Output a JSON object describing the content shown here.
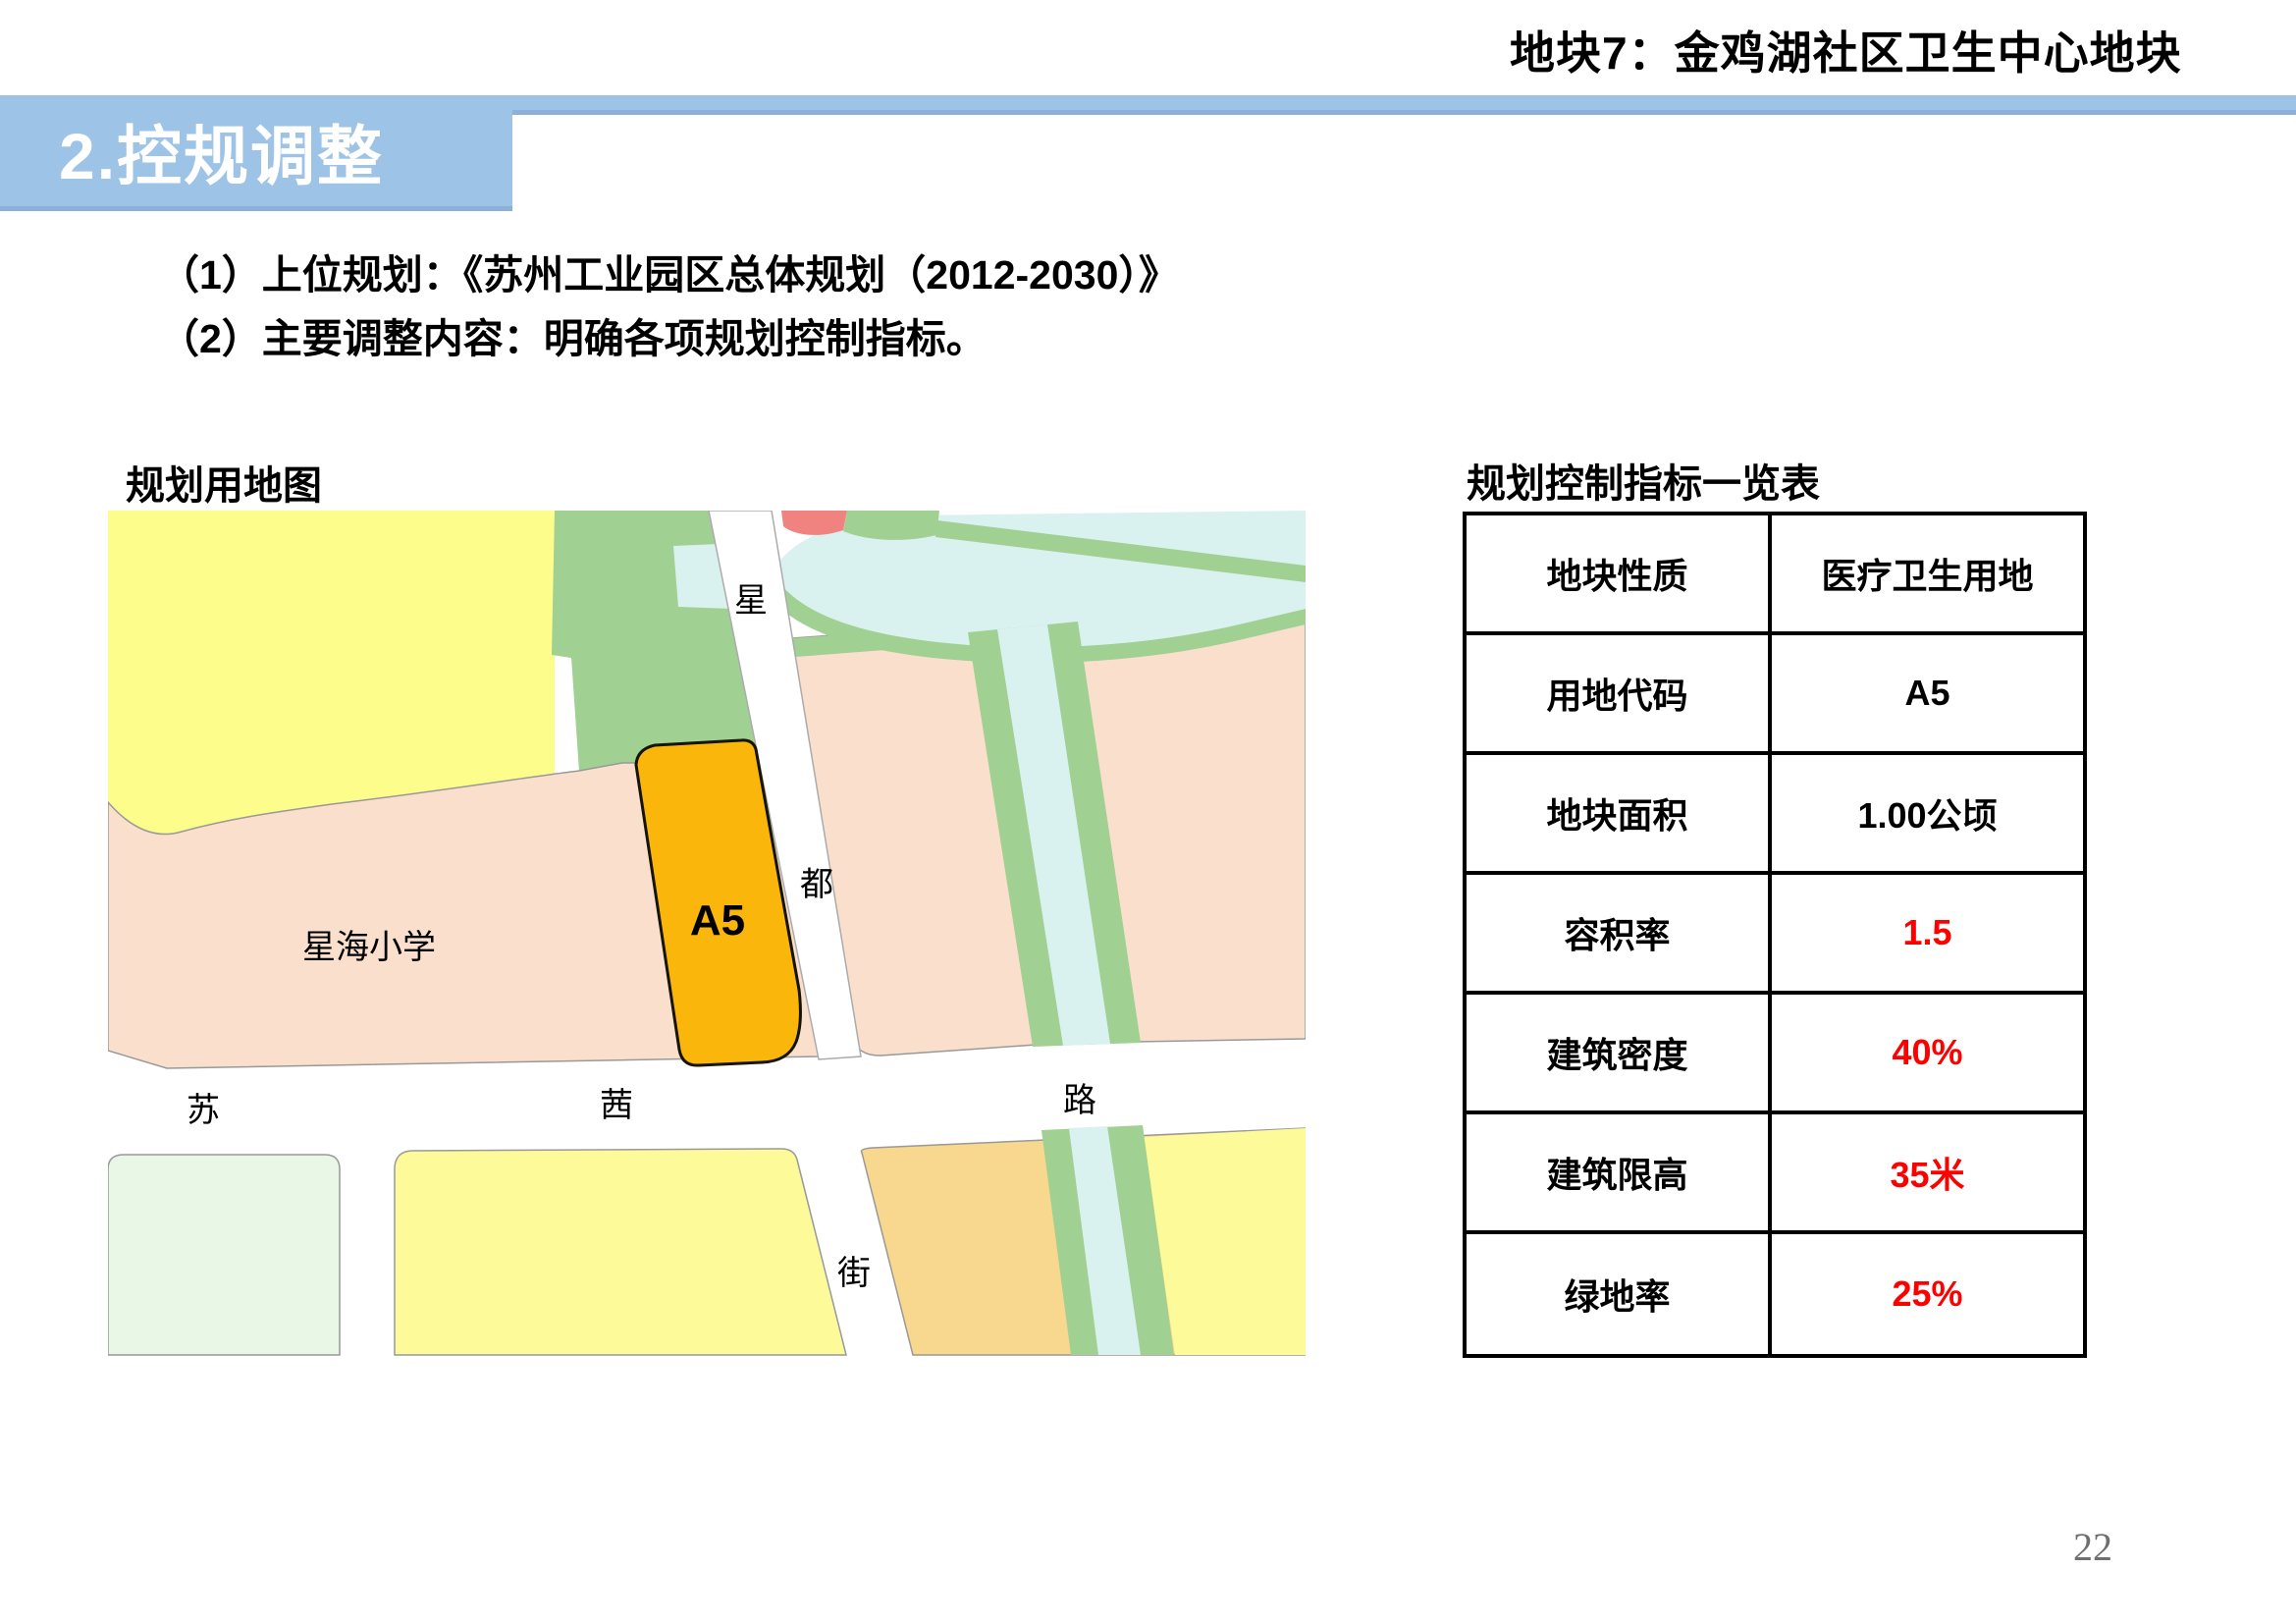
{
  "header": {
    "plot_title": "地块7：金鸡湖社区卫生中心地块",
    "section": "2.控规调整"
  },
  "intro": {
    "line1": "（1）上位规划：《苏州工业园区总体规划（2012-2030）》",
    "line2": "（2）主要调整内容：明确各项规划控制指标。"
  },
  "map": {
    "caption": "规划用地图",
    "labels": {
      "road_star": "星",
      "road_du": "都",
      "road_jie": "街",
      "road_su": "苏",
      "road_qian": "茜",
      "road_lu": "路",
      "plot_code": "A5",
      "school": "星海小学"
    }
  },
  "table": {
    "caption": "规划控制指标一览表",
    "rows": [
      {
        "label": "地块性质",
        "value": "医疗卫生用地",
        "value_color": "#000000"
      },
      {
        "label": "用地代码",
        "value": "A5",
        "value_color": "#000000"
      },
      {
        "label": "地块面积",
        "value": "1.00公顷",
        "value_color": "#000000"
      },
      {
        "label": "容积率",
        "value": "1.5",
        "value_color": "#FF0000"
      },
      {
        "label": "建筑密度",
        "value": "40%",
        "value_color": "#FF0000"
      },
      {
        "label": "建筑限高",
        "value": "35米",
        "value_color": "#FF0000"
      },
      {
        "label": "绿地率",
        "value": "25%",
        "value_color": "#FF0000"
      }
    ]
  },
  "page_number": "22",
  "colors": {
    "header_bar": "#9DC3E6",
    "header_bar_edge": "#8CB0D9",
    "value_red": "#FF0000",
    "page_number_gray": "#6F6F6F",
    "map": {
      "yellow": "#FDFD8B",
      "green": "#A1D093",
      "cyan": "#D9F2F0",
      "peach": "#FAE0CC",
      "mint": "#E9F7E6",
      "pale_yellow": "#FDFA9A",
      "orange_block": "#F8D78E",
      "plot_orange": "#FBB60B",
      "red_parcel": "#F0837F",
      "road_white": "#FFFFFF",
      "block_border": "#999999"
    }
  }
}
